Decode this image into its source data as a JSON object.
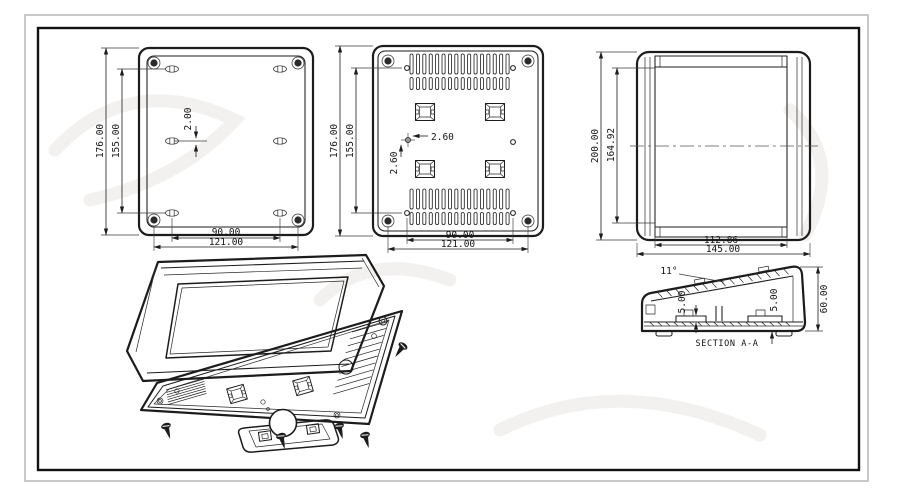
{
  "views": {
    "front": {
      "dims": {
        "height": "176.00",
        "hole_spacing_v": "155.00",
        "center_offset": "2.00",
        "hole_spacing_h": "90.00",
        "mount_width": "121.00"
      }
    },
    "back": {
      "dims": {
        "height": "176.00",
        "hole_spacing_v": "155.00",
        "offset_x": "2.60",
        "offset_y": "2.60",
        "hole_spacing_h": "90.00",
        "mount_width": "121.00"
      }
    },
    "side": {
      "dims": {
        "height": "200.00",
        "inner_height": "164.92",
        "inner_depth": "112.86",
        "depth": "145.00"
      }
    },
    "section": {
      "label": "SECTION A-A",
      "dims": {
        "slope_angle": "11°",
        "boss_height_left": "5.00",
        "boss_height_right": "5.00",
        "height": "60.00"
      }
    }
  },
  "colors": {
    "line": "#1c1c1c",
    "frame_outer": "#c9c9c9",
    "frame_inner": "#111111",
    "background": "#ffffff",
    "watermark": "#f1efec"
  }
}
